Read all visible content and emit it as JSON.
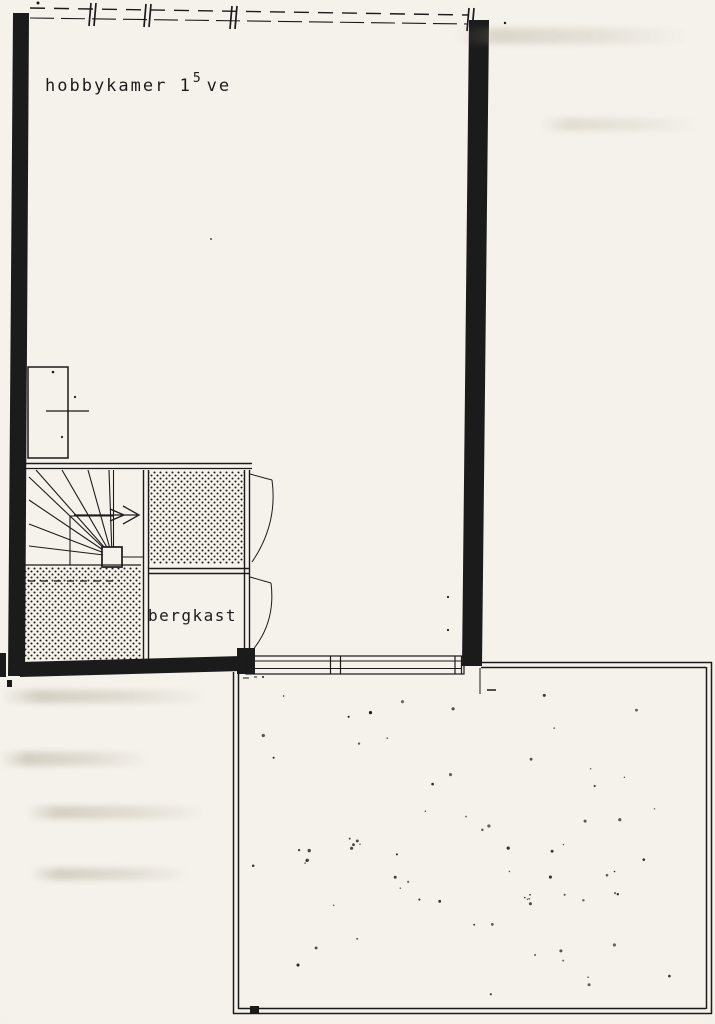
{
  "colors": {
    "paper": "#f5f2eb",
    "ink": "#1b1b1b"
  },
  "plan": {
    "type": "scanned-floor-plan",
    "rooms": [
      {
        "id": "hobbykamer",
        "label_prefix": "hobbykamer 1",
        "label_sup": "5",
        "label_suffix": "ve"
      },
      {
        "id": "bergkast",
        "label": "bergkast"
      }
    ]
  }
}
